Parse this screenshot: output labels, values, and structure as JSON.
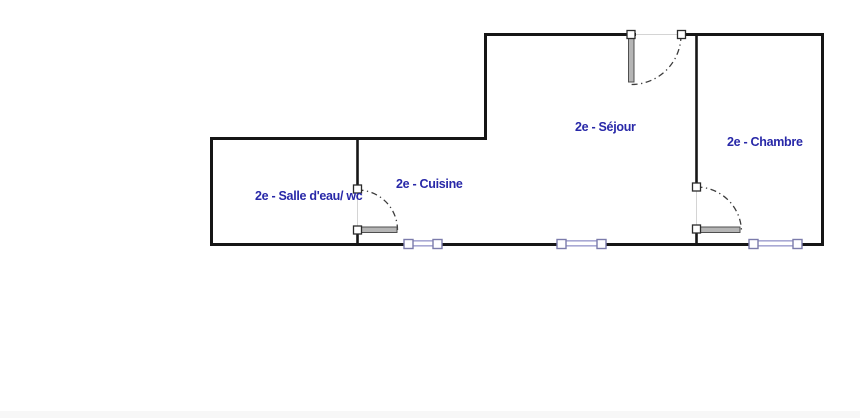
{
  "floorplan": {
    "floor": "2e",
    "rooms": [
      {
        "id": "sejour",
        "label": "2e - Séjour"
      },
      {
        "id": "chambre",
        "label": "2e - Chambre"
      },
      {
        "id": "cuisine",
        "label": "2e - Cuisine"
      },
      {
        "id": "salle-deau-wc",
        "label": "2e - Salle d'eau/ wc"
      }
    ],
    "doors": [
      {
        "id": "door-sejour-entry",
        "location": "top wall of séjour",
        "type": "swing-door"
      },
      {
        "id": "door-chambre",
        "location": "wall between séjour and chambre",
        "type": "swing-door"
      },
      {
        "id": "door-salle-deau-wc",
        "location": "wall between salle d'eau and cuisine",
        "type": "swing-door"
      }
    ],
    "windows": [
      {
        "id": "window-cuisine",
        "location": "bottom wall, cuisine"
      },
      {
        "id": "window-sejour",
        "location": "bottom wall, séjour"
      },
      {
        "id": "window-chambre",
        "location": "bottom wall, chambre"
      }
    ],
    "colors": {
      "background": "#ffffff",
      "wall": "#161616",
      "label-text": "#2828a8",
      "door-leaf": "#b5b5b5",
      "door-leaf-border": "#4f4f4f",
      "door-arc": "#3c3c3c",
      "door-square-border": "#2b2b2b",
      "window-line": "#a9a9d4",
      "window-border": "#7b7bab",
      "opening-line": "#d4d4d4"
    }
  }
}
